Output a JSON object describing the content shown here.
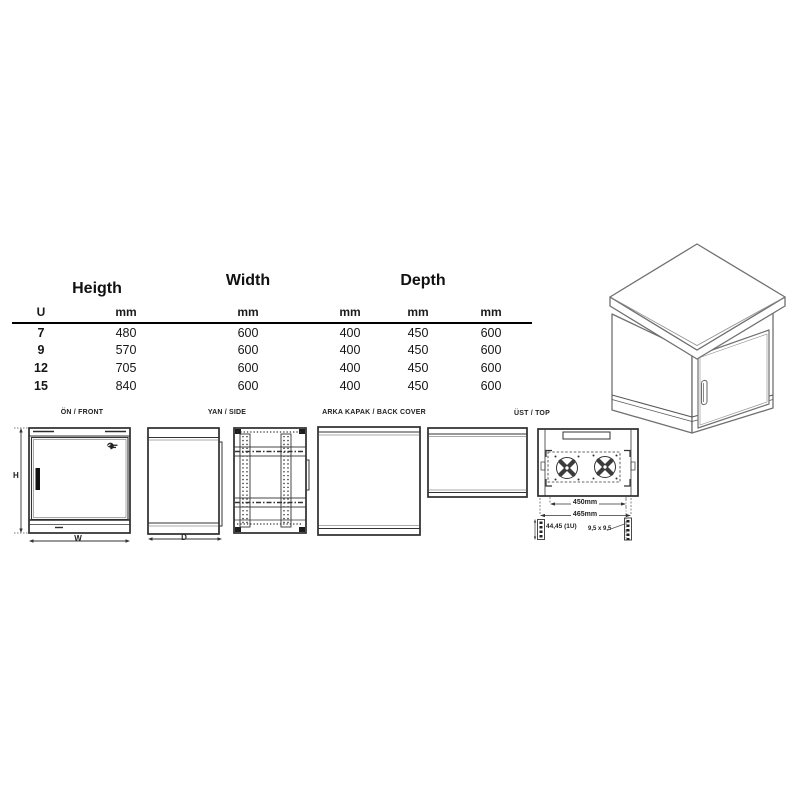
{
  "table": {
    "group_headers": {
      "height": "Heigth",
      "width": "Width",
      "depth": "Depth"
    },
    "unit_header": {
      "u": "U",
      "mm1": "mm",
      "mm2": "mm",
      "mm3": "mm",
      "mm4": "mm",
      "mm5": "mm"
    },
    "rows": [
      {
        "u": "7",
        "height_mm": "480",
        "width_mm": "600",
        "depth_mm1": "400",
        "depth_mm2": "450",
        "depth_mm3": "600"
      },
      {
        "u": "9",
        "height_mm": "570",
        "width_mm": "600",
        "depth_mm1": "400",
        "depth_mm2": "450",
        "depth_mm3": "600"
      },
      {
        "u": "12",
        "height_mm": "705",
        "width_mm": "600",
        "depth_mm1": "400",
        "depth_mm2": "450",
        "depth_mm3": "600"
      },
      {
        "u": "15",
        "height_mm": "840",
        "width_mm": "600",
        "depth_mm1": "400",
        "depth_mm2": "450",
        "depth_mm3": "600"
      }
    ]
  },
  "views": {
    "front": {
      "label": "ÖN / FRONT",
      "height_dim": "H",
      "width_dim": "W"
    },
    "side": {
      "label": "YAN / SIDE",
      "depth_dim": "D"
    },
    "back": {
      "label": "ARKA KAPAK / BACK COVER"
    },
    "top": {
      "label": "ÜST / TOP",
      "inner_width": "450mm",
      "outer_width": "465mm",
      "rack_unit_pitch": "44,45 (1U)",
      "hole_size": "9,5 x 9,5"
    }
  },
  "colors": {
    "line": "#333333",
    "line_3d": "#707070",
    "text": "#1b1b1b",
    "background": "#ffffff"
  }
}
